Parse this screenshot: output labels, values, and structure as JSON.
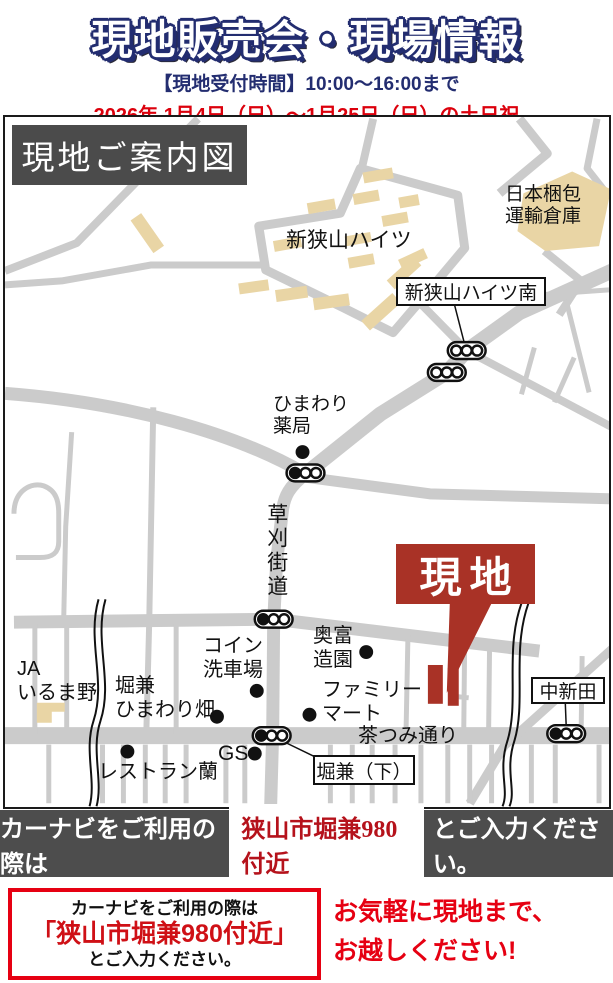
{
  "header": {
    "title": "現地販売会・現場情報",
    "reception": "【現地受付時間】10:00～16:00まで",
    "dates": "2026年 1月4日（日）～1月25日（日）の土日祝"
  },
  "map": {
    "title": "現地ご案内図",
    "site_label": "現地",
    "labels": {
      "housing": "新狭山ハイツ",
      "warehouse": "日本梱包\n運輸倉庫",
      "signal_south": "新狭山ハイツ南",
      "pharmacy": "ひまわり\n薬局",
      "kusakari_road": "草刈街道",
      "ja": "JA\nいるま野",
      "himawari_field": "堀兼\nひまわり畑",
      "coin_wash": "コイン\n洗車場",
      "okutomi": "奥富\n造園",
      "familymart": "ファミリー\nマート",
      "nakashinden": "中新田",
      "chatsumi": "茶つみ通り",
      "gs": "GS",
      "horikane_shimo": "堀兼（下）",
      "restaurant": "レストラン蘭"
    },
    "icons": {
      "traffic_signal": "traffic-signal-icon (pill with three lamps)",
      "poi_dot": "poi-dot (black filled circle)",
      "site_marker": "site-marker (red callout arrow + site rectangles)"
    }
  },
  "navi_bar": {
    "prefix": "カーナビをご利用の際は",
    "address": "狭山市堀兼980付近",
    "suffix": "とご入力ください。"
  },
  "footer": {
    "navi_box": {
      "line1": "カーナビをご利用の際は",
      "line2": "「狭山市堀兼980付近」",
      "line3": "とご入力ください。"
    },
    "invite": "お気軽に現地まで、\nお越しください!"
  },
  "colors": {
    "navy": "#232d70",
    "bright_red": "#e60012",
    "date_red": "#dc000c",
    "address_red": "#b5121b",
    "site_red": "#a93226",
    "road_gray": "#cbcbcb",
    "building_tan": "#e9d5a5",
    "bar_gray": "#4d4d4d"
  }
}
